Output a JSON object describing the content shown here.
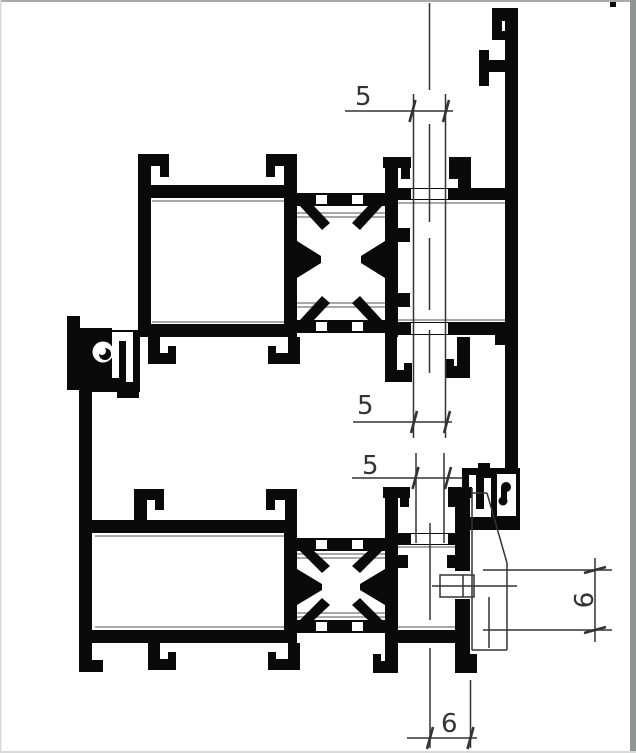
{
  "drawing": {
    "kind": "aluminium-profile-cross-section",
    "dimensions": {
      "upper_glass": {
        "label": "5",
        "orientation": "horizontal"
      },
      "middle_glass": {
        "label": "5",
        "orientation": "horizontal"
      },
      "lower_glass": {
        "label": "5",
        "orientation": "horizontal"
      },
      "bottom_gap": {
        "label": "6",
        "orientation": "horizontal"
      },
      "side_gap": {
        "label": "9",
        "orientation": "vertical-rotated"
      }
    },
    "colors": {
      "profile": "#0a0a0a",
      "dim": "#333333",
      "gasket": "#9c9c9c",
      "bg": "#ffffff",
      "border-top": "#ababab",
      "border-right": "#8f9595",
      "border-light": "#d9d9d9"
    }
  }
}
